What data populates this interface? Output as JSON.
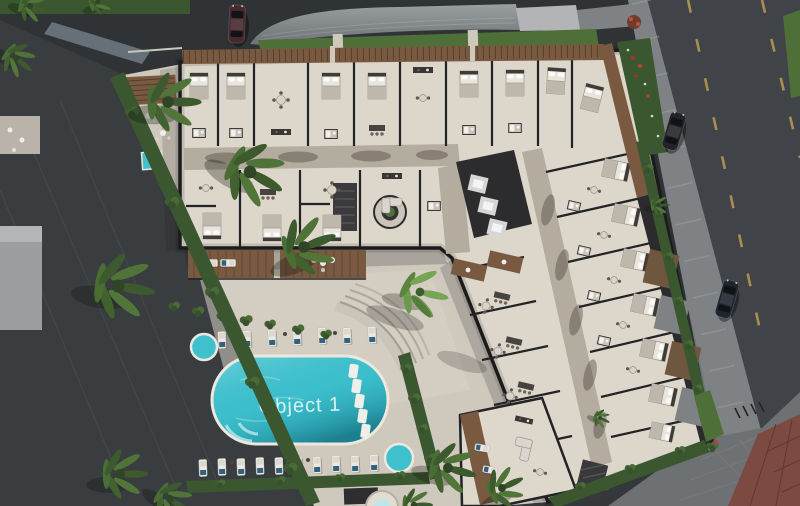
{
  "meta": {
    "type": "aerial-3d-architectural-render",
    "subject": "Top-down render of an L-shaped residential building with cutaway apartment floor plan, pool courtyard, palm trees, roads and parked cars"
  },
  "pool": {
    "label": "Object 1",
    "label_color": "#e9fbfb",
    "water_color": "#3ec0cd",
    "deep_color": "#1a8495"
  },
  "colors": {
    "asphalt": "#35383b",
    "road": "#404448",
    "sidewalk": "#7e8285",
    "plaza": "#6e7174",
    "red_pavers": "#7c4a40",
    "courtyard": "#cfc8bc",
    "building_floor": "#dcd6cb",
    "walls": "#232325",
    "corridor": "#b4ac9e",
    "wood": "#79593f",
    "hedge": "#3a5730",
    "grass": "#4e7038",
    "lane_marking": "#a98e4f",
    "neighbor_roof": "#868c8d",
    "left_building": "#9c9da0",
    "car_top_left": "#46292d",
    "car_right_1": "#222428",
    "car_right_2": "#1f2430",
    "lounger": "#ebe9e2",
    "towel": "#32617e"
  }
}
